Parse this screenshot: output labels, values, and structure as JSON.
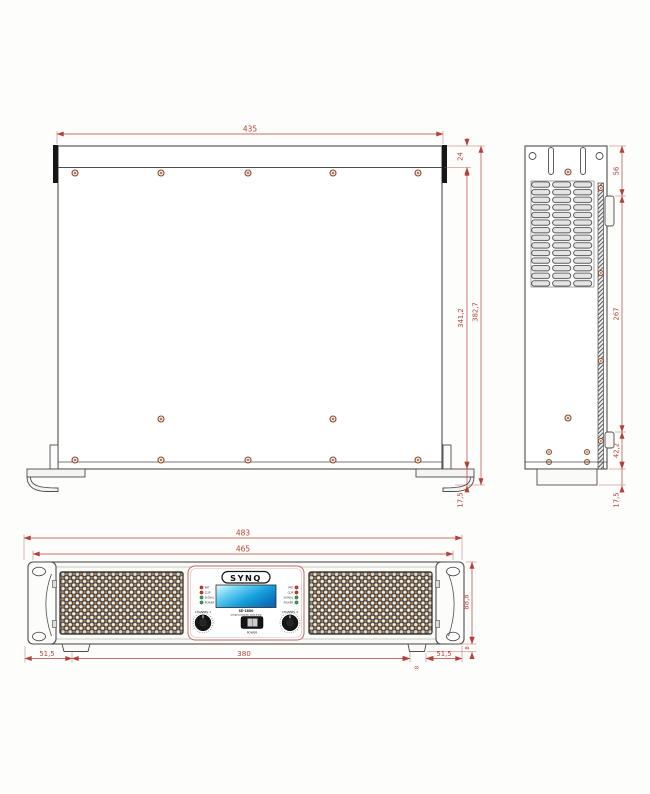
{
  "dims": {
    "top_view": {
      "width": "435",
      "front_depth": "24",
      "body_depth": "341,2",
      "total_depth": "382,7",
      "foot_height": "17,5"
    },
    "side_view": {
      "upper_section": "56",
      "mid_section": "267",
      "lower_section": "42,2",
      "foot_height": "17,5"
    },
    "front_view": {
      "total_width": "483",
      "panel_width": "465",
      "panel_height": "88,8",
      "feet_span": "380",
      "left_inset": "51,5",
      "right_inset": "51,5",
      "foot_width": "8",
      "foot_height": "8"
    }
  },
  "front_panel": {
    "brand": "SYNQ",
    "model": "SE-1800",
    "subtitle": "STEREO POWER AMPLIFIER",
    "channel_1_label": "CHANNEL 1",
    "channel_2_label": "CHANNEL 2",
    "power_label": "POWER",
    "led_labels": [
      "PRT",
      "CLIP",
      "SIGNAL",
      "POWER"
    ],
    "led_colors": [
      "#d43425",
      "#d43425",
      "#2fa054",
      "#2fa054"
    ]
  },
  "colors": {
    "dimension": "#b5403a",
    "outline": "#4d4d4d",
    "screw": "#8a4a35",
    "grille_dot": "#c8823e",
    "lcd_gradient_start": "#e8fbff",
    "lcd_gradient_end": "#0a6cb8"
  }
}
